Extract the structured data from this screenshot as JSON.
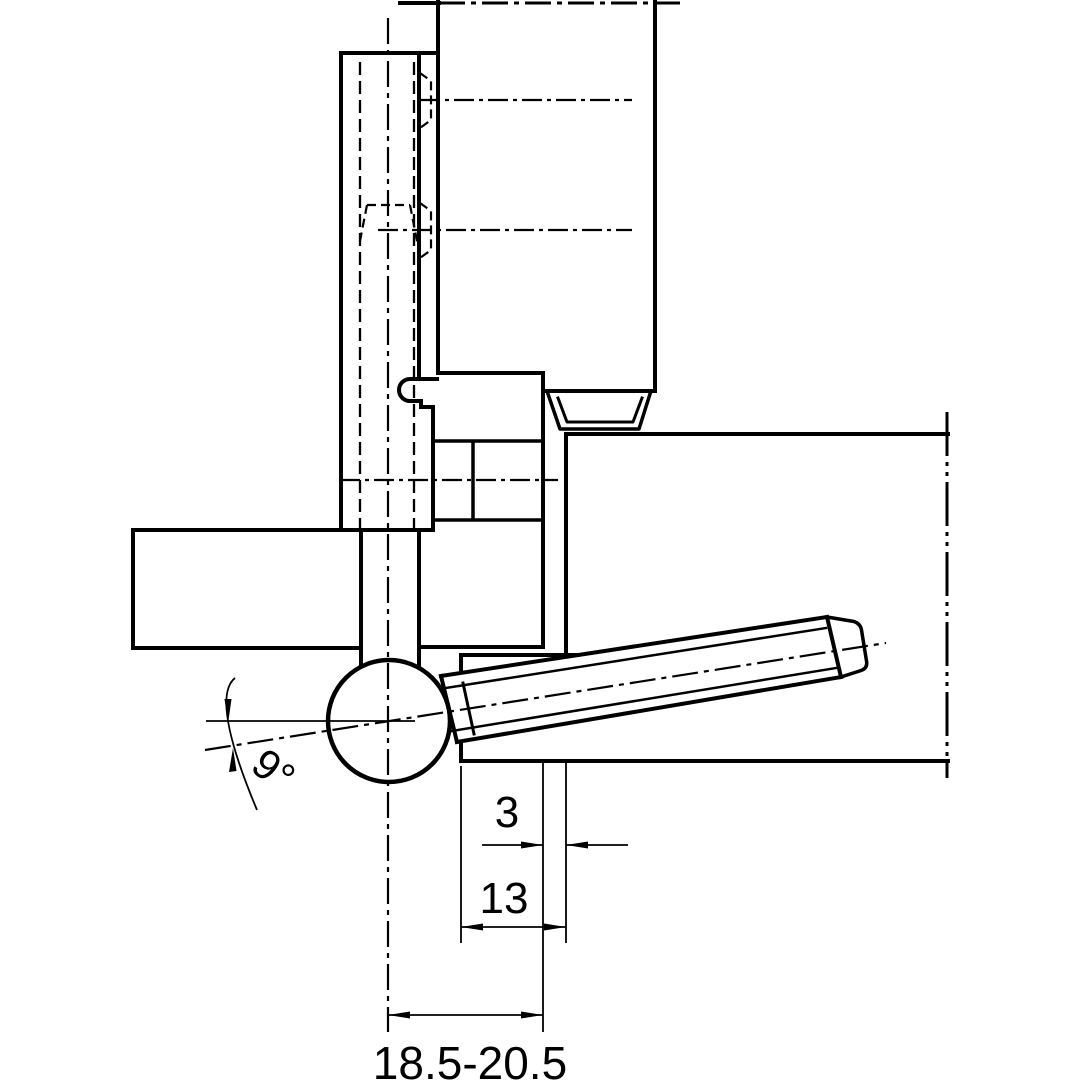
{
  "page": {
    "background": "#ffffff",
    "line_color": "#000000"
  },
  "drawing": {
    "kind": "technical-drawing",
    "subject": "drill-in door hinge installation cross-section",
    "dimensions": {
      "angle": "9°",
      "seal_gap": "3",
      "rebate_depth": "13",
      "drill_range": "18.5-20.5"
    }
  }
}
